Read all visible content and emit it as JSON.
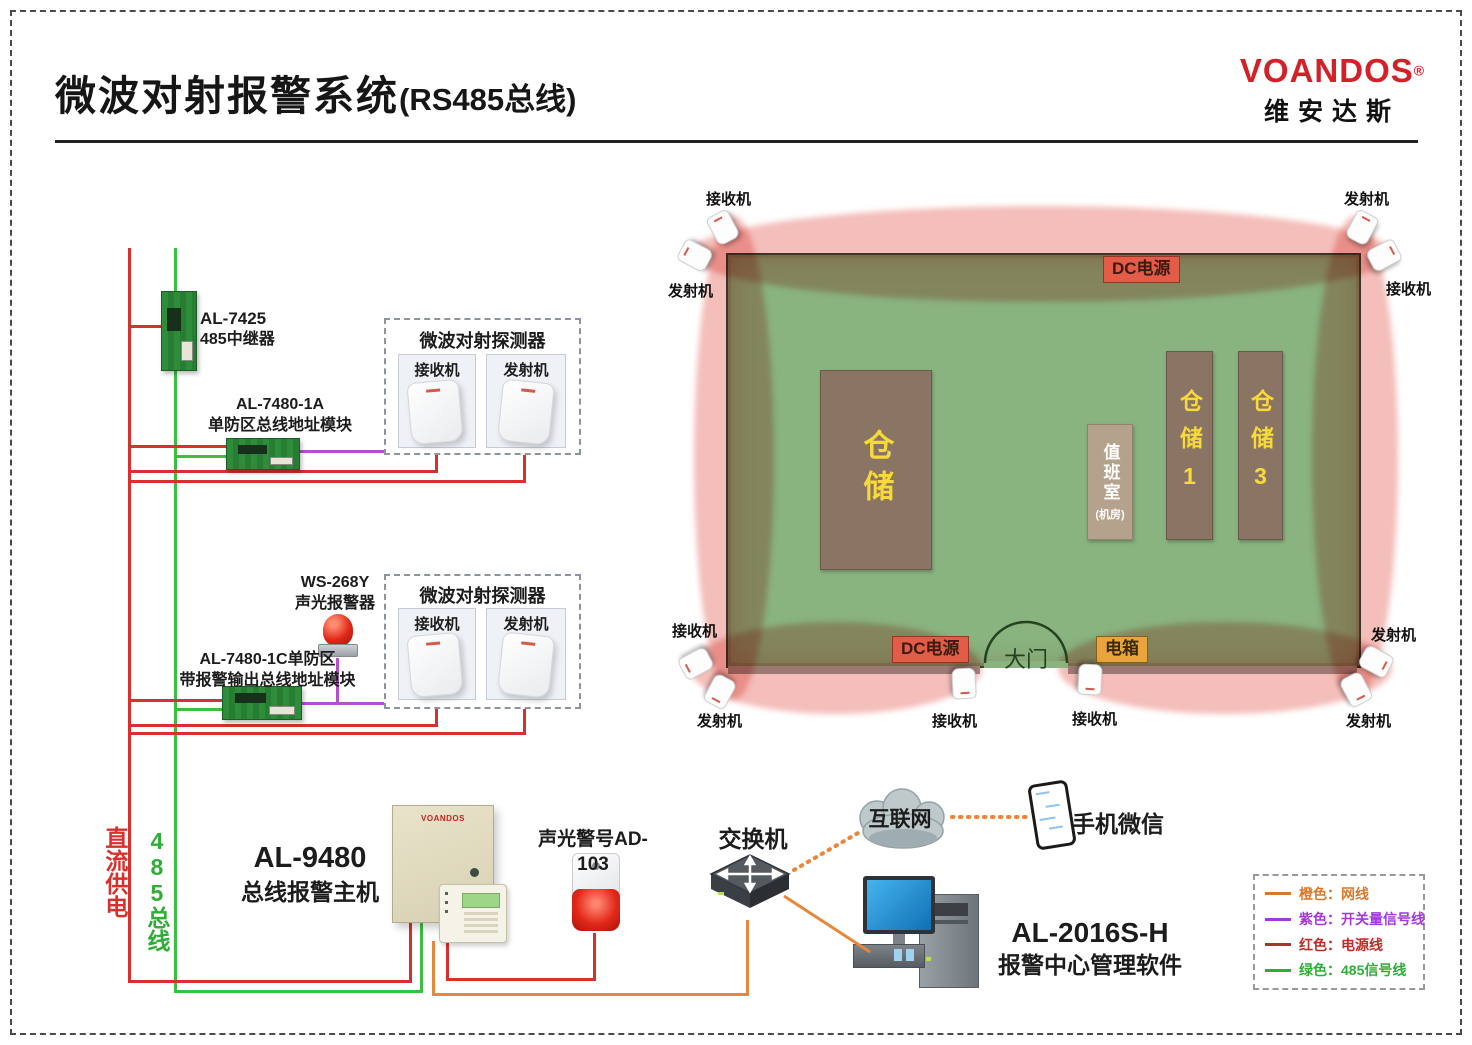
{
  "header": {
    "title": "微波对射报警系统",
    "title_suffix": "(RS485总线)",
    "brand": "VOANDOS",
    "brand_reg": "®",
    "brand_cn": "维安达斯"
  },
  "bus": {
    "dc_label": "直流供电",
    "rs485_label": "485总线"
  },
  "schematic": {
    "repeater_model": "AL-7425",
    "repeater_name": "485中继器",
    "module1a_model": "AL-7480-1A",
    "module1a_name": "单防区总线地址模块",
    "detector_title": "微波对射探测器",
    "receiver_label": "接收机",
    "transmitter_label": "发射机",
    "sounder_model": "WS-268Y",
    "sounder_name": "声光报警器",
    "module1c_line1": "AL-7480-1C单防区",
    "module1c_line2": "带报警输出总线地址模块"
  },
  "bottom": {
    "host_model": "AL-9480",
    "host_name": "总线报警主机",
    "host_brand": "VOANDOS",
    "siren_label": "声光警号AD-103",
    "switch_label": "交换机",
    "internet_label": "互联网",
    "wechat_label": "手机微信",
    "software_model": "AL-2016S-H",
    "software_name": "报警中心管理软件"
  },
  "plan": {
    "buildings": [
      {
        "label": "仓储"
      },
      {
        "label": "值班室",
        "sub": "(机房)"
      },
      {
        "label": "仓储1"
      },
      {
        "label": "仓储3"
      }
    ],
    "badges": [
      {
        "label": "DC电源"
      },
      {
        "label": "DC电源"
      },
      {
        "label": "电箱"
      }
    ],
    "gate_label": "大门",
    "device_labels": [
      {
        "label": "接收机"
      },
      {
        "label": "发射机"
      },
      {
        "label": "发射机"
      },
      {
        "label": "接收机"
      },
      {
        "label": "接收机"
      },
      {
        "label": "发射机"
      },
      {
        "label": "接收机"
      },
      {
        "label": "接收机"
      },
      {
        "label": "发射机"
      },
      {
        "label": "发射机"
      }
    ]
  },
  "legend": {
    "items": [
      {
        "label": "橙色：网线",
        "color": "#d9782a"
      },
      {
        "label": "紫色：开关量信号线",
        "color": "#a438d8"
      },
      {
        "label": "红色：电源线",
        "color": "#b5302a"
      },
      {
        "label": "绿色：485信号线",
        "color": "#2fae36"
      }
    ]
  },
  "colors": {
    "brand_red": "#d42027",
    "wire_red": "#d8302c",
    "wire_green": "#3abf42",
    "wire_purple": "#b44fd0",
    "wire_orange": "#e8873c",
    "plan_green": "#89b37f",
    "beam_pink": "#f4beba"
  }
}
